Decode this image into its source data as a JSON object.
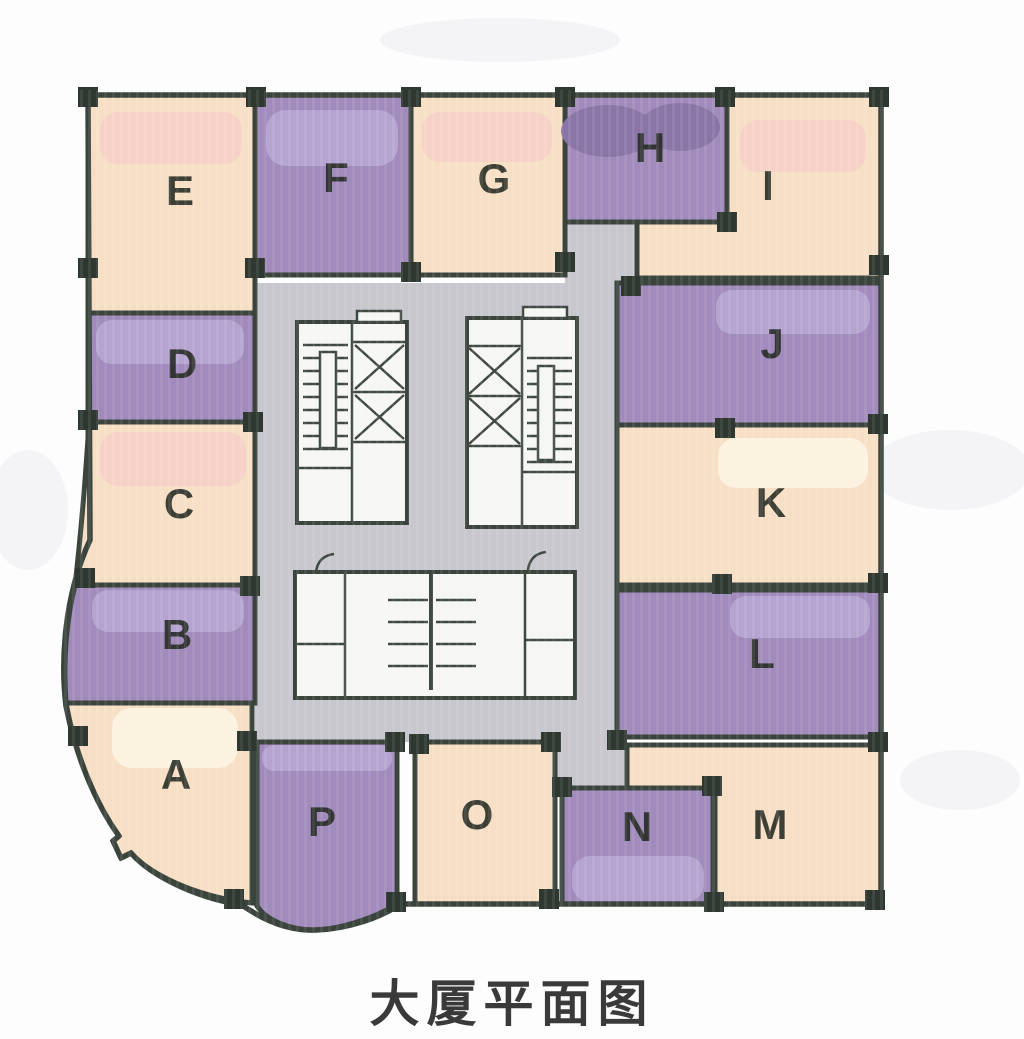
{
  "caption": "大厦平面图",
  "palette": {
    "background": "#fdfdfd",
    "peach": "#f7dfc6",
    "cream_highlight": "#fdf2e0",
    "pink_highlight": "#f6d1c5",
    "purple": "#a18abc",
    "purple_highlight": "#b6a4d0",
    "purple_dark_highlight": "#8b75a7",
    "core_gray": "#c8c7cd",
    "core_white": "#f6f6f4",
    "wall": "#3a433c",
    "fixture_line": "#3f4841",
    "column": "#2e3730",
    "room_label": "#242a22",
    "caption_color": "#3a3a3a",
    "smudge": "#e9e7ee"
  },
  "rooms": [
    {
      "label": "E",
      "fill": "peach",
      "shape": {
        "type": "rect",
        "x": 88,
        "y": 95,
        "w": 167,
        "h": 218
      },
      "label_pos": [
        180,
        205
      ],
      "blobs": [
        {
          "type": "rect",
          "fill": "pink_highlight",
          "x": 100,
          "y": 112,
          "w": 142,
          "h": 52,
          "r": 18
        }
      ]
    },
    {
      "label": "F",
      "fill": "purple",
      "shape": {
        "type": "rect",
        "x": 255,
        "y": 95,
        "w": 156,
        "h": 180
      },
      "label_pos": [
        336,
        192
      ],
      "blobs": [
        {
          "type": "rect",
          "fill": "purple_highlight",
          "x": 266,
          "y": 110,
          "w": 132,
          "h": 56,
          "r": 20
        }
      ]
    },
    {
      "label": "G",
      "fill": "peach",
      "shape": {
        "type": "rect",
        "x": 411,
        "y": 95,
        "w": 154,
        "h": 180
      },
      "label_pos": [
        494,
        193
      ],
      "blobs": [
        {
          "type": "rect",
          "fill": "pink_highlight",
          "x": 422,
          "y": 112,
          "w": 130,
          "h": 50,
          "r": 18
        }
      ]
    },
    {
      "label": "H",
      "fill": "purple",
      "shape": {
        "type": "rect",
        "x": 565,
        "y": 95,
        "w": 162,
        "h": 127
      },
      "label_pos": [
        650,
        162
      ],
      "blobs": [
        {
          "type": "ellipse",
          "fill": "purple_dark_highlight",
          "cx": 608,
          "cy": 131,
          "rx": 47,
          "ry": 26
        },
        {
          "type": "ellipse",
          "fill": "purple_dark_highlight",
          "cx": 680,
          "cy": 127,
          "rx": 40,
          "ry": 24
        }
      ]
    },
    {
      "label": "I",
      "fill": "peach",
      "shape": {
        "type": "path",
        "d": "M 727,95 L 881,95 L 881,278 L 637,278 L 637,222 L 727,222 Z"
      },
      "label_pos": [
        768,
        200
      ],
      "blobs": [
        {
          "type": "rect",
          "fill": "pink_highlight",
          "x": 740,
          "y": 120,
          "w": 126,
          "h": 52,
          "r": 18
        }
      ]
    },
    {
      "label": "D",
      "fill": "purple",
      "shape": {
        "type": "rect",
        "x": 88,
        "y": 313,
        "w": 167,
        "h": 109
      },
      "label_pos": [
        182,
        378
      ],
      "blobs": [
        {
          "type": "rect",
          "fill": "purple_highlight",
          "x": 96,
          "y": 320,
          "w": 148,
          "h": 44,
          "r": 16
        }
      ]
    },
    {
      "label": "C",
      "fill": "peach",
      "shape": {
        "type": "path",
        "d": "M 88,422 L 255,422 L 255,585 L 75,585 C 81,534 86,468 88,438 Z"
      },
      "label_pos": [
        179,
        518
      ],
      "blobs": [
        {
          "type": "rect",
          "fill": "pink_highlight",
          "x": 100,
          "y": 432,
          "w": 146,
          "h": 54,
          "r": 18
        }
      ]
    },
    {
      "label": "B",
      "fill": "purple",
      "shape": {
        "type": "path",
        "d": "M 75,585 L 255,585 L 255,703 L 66,703 C 63,661 66,622 75,585 Z"
      },
      "label_pos": [
        177,
        649
      ],
      "blobs": [
        {
          "type": "rect",
          "fill": "purple_highlight",
          "x": 92,
          "y": 590,
          "w": 152,
          "h": 42,
          "r": 16
        }
      ]
    },
    {
      "label": "A",
      "fill": "peach",
      "shape": {
        "type": "path",
        "d": "M 66,703 L 252,703 L 252,903 C 200,898 152,876 131,853 L 121,858 L 113,841 L 119,836 C 96,804 76,757 66,703 Z"
      },
      "label_pos": [
        176,
        789
      ],
      "blobs": [
        {
          "type": "rect",
          "fill": "cream_highlight",
          "x": 112,
          "y": 708,
          "w": 126,
          "h": 60,
          "r": 20
        }
      ]
    },
    {
      "label": "J",
      "fill": "purple",
      "shape": {
        "type": "rect",
        "x": 617,
        "y": 283,
        "w": 264,
        "h": 142
      },
      "label_pos": [
        772,
        358
      ],
      "blobs": [
        {
          "type": "rect",
          "fill": "purple_highlight",
          "x": 716,
          "y": 290,
          "w": 154,
          "h": 44,
          "r": 16
        }
      ]
    },
    {
      "label": "K",
      "fill": "peach",
      "shape": {
        "type": "rect",
        "x": 617,
        "y": 425,
        "w": 264,
        "h": 160
      },
      "label_pos": [
        771,
        517
      ],
      "blobs": [
        {
          "type": "rect",
          "fill": "cream_highlight",
          "x": 718,
          "y": 438,
          "w": 150,
          "h": 50,
          "r": 18
        }
      ]
    },
    {
      "label": "L",
      "fill": "purple",
      "shape": {
        "type": "rect",
        "x": 617,
        "y": 590,
        "w": 264,
        "h": 147
      },
      "label_pos": [
        762,
        668
      ],
      "blobs": [
        {
          "type": "rect",
          "fill": "purple_highlight",
          "x": 730,
          "y": 596,
          "w": 140,
          "h": 42,
          "r": 16
        }
      ]
    },
    {
      "label": "M",
      "fill": "peach",
      "shape": {
        "type": "path",
        "d": "M 627,745 L 881,745 L 881,904 L 715,904 L 715,788 L 627,788 Z"
      },
      "label_pos": [
        770,
        839
      ],
      "blobs": []
    },
    {
      "label": "N",
      "fill": "purple",
      "shape": {
        "type": "rect",
        "x": 562,
        "y": 788,
        "w": 151,
        "h": 116
      },
      "label_pos": [
        637,
        841
      ],
      "blobs": [
        {
          "type": "rect",
          "fill": "purple_highlight",
          "x": 572,
          "y": 856,
          "w": 132,
          "h": 46,
          "r": 18
        }
      ]
    },
    {
      "label": "O",
      "fill": "peach",
      "shape": {
        "type": "rect",
        "x": 415,
        "y": 742,
        "w": 140,
        "h": 162
      },
      "label_pos": [
        477,
        829
      ],
      "blobs": []
    },
    {
      "label": "P",
      "fill": "purple",
      "shape": {
        "type": "path",
        "d": "M 257,742 L 397,742 L 397,904 C 372,920 335,930 312,930 C 288,929 266,920 257,906 Z"
      },
      "label_pos": [
        322,
        836
      ],
      "blobs": [
        {
          "type": "rect",
          "fill": "purple_highlight",
          "x": 262,
          "y": 745,
          "w": 130,
          "h": 26,
          "r": 12
        }
      ]
    }
  ],
  "core": {
    "corridor_rects": [
      {
        "name": "core-corridor",
        "x": 255,
        "y": 283,
        "w": 362,
        "h": 459
      },
      {
        "name": "corridor-stub-top",
        "x": 565,
        "y": 222,
        "w": 72,
        "h": 64
      },
      {
        "name": "corridor-stub-bottom",
        "x": 557,
        "y": 742,
        "w": 70,
        "h": 48
      }
    ],
    "service_boxes": [
      {
        "name": "stair-elevator-block-left",
        "x": 297,
        "y": 322,
        "w": 110,
        "h": 201
      },
      {
        "name": "stair-elevator-block-right",
        "x": 467,
        "y": 318,
        "w": 110,
        "h": 209
      },
      {
        "name": "restroom-block",
        "x": 295,
        "y": 572,
        "w": 280,
        "h": 126
      }
    ]
  },
  "columns": [
    [
      88,
      97
    ],
    [
      256,
      97
    ],
    [
      411,
      97
    ],
    [
      565,
      97
    ],
    [
      725,
      97
    ],
    [
      879,
      97
    ],
    [
      88,
      268
    ],
    [
      255,
      268
    ],
    [
      411,
      272
    ],
    [
      565,
      262
    ],
    [
      631,
      286
    ],
    [
      727,
      222
    ],
    [
      879,
      265
    ],
    [
      88,
      420
    ],
    [
      253,
      422
    ],
    [
      725,
      428
    ],
    [
      878,
      424
    ],
    [
      85,
      578
    ],
    [
      250,
      586
    ],
    [
      722,
      584
    ],
    [
      878,
      583
    ],
    [
      78,
      736
    ],
    [
      247,
      741
    ],
    [
      395,
      742
    ],
    [
      419,
      744
    ],
    [
      551,
      742
    ],
    [
      617,
      740
    ],
    [
      878,
      742
    ],
    [
      562,
      787
    ],
    [
      712,
      786
    ],
    [
      234,
      899
    ],
    [
      396,
      902
    ],
    [
      549,
      899
    ],
    [
      714,
      902
    ],
    [
      875,
      900
    ]
  ]
}
